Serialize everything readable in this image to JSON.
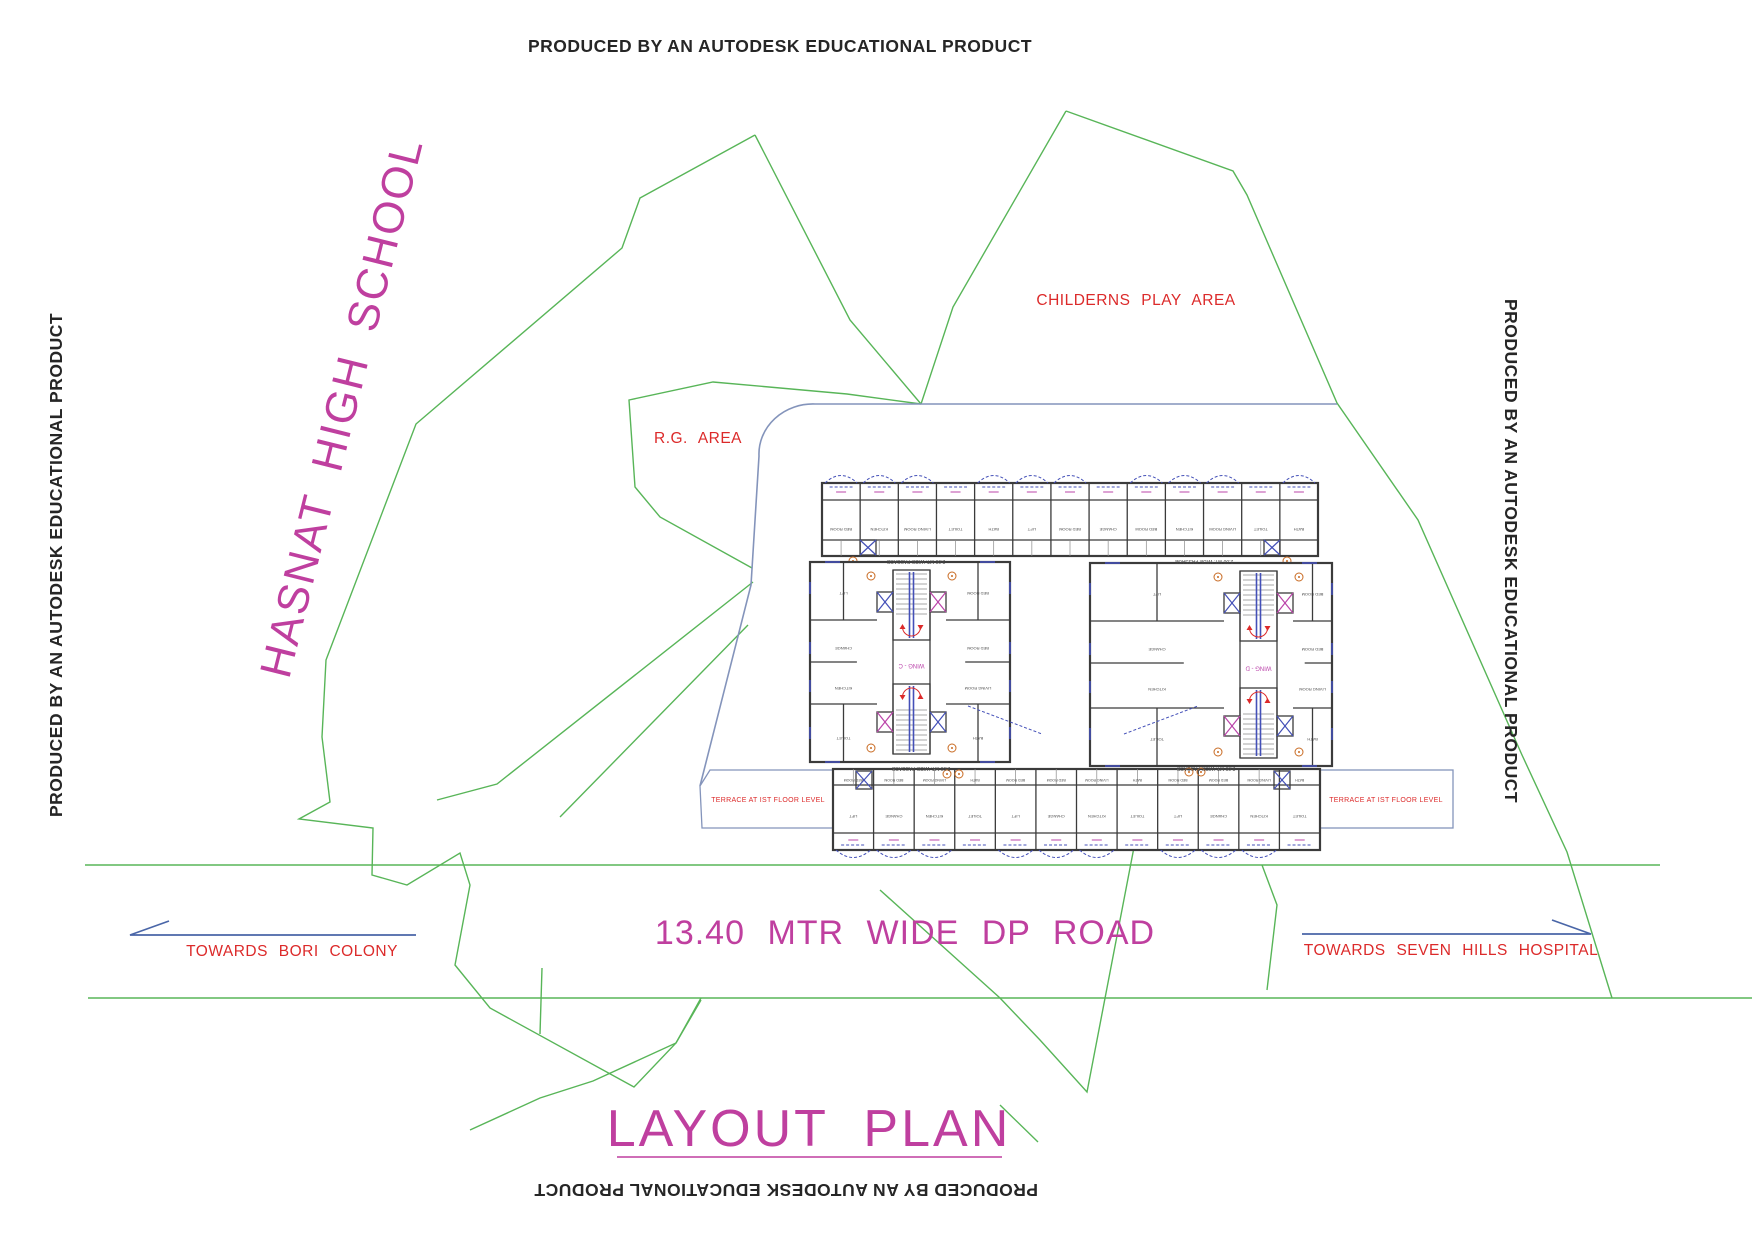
{
  "banners": {
    "produced": "PRODUCED BY AN AUTODESK EDUCATIONAL PRODUCT"
  },
  "site": {
    "school": "HASNAT HIGH SCHOOL",
    "childrens_play_area": "CHILDERNS PLAY AREA",
    "rg_area": "R.G. AREA",
    "road_label": "13.40 MTR WIDE DP ROAD",
    "towards_left": "TOWARDS BORI COLONY",
    "towards_right": "TOWARDS SEVEN HILLS HOSPITAL",
    "plan_title": "LAYOUT PLAN"
  },
  "plan": {
    "terrace_left": "TERRACE AT IST FLOOR LEVEL",
    "terrace_right": "TERRACE AT IST FLOOR LEVEL",
    "passage_label": "2.00 MT. WIDE PASSAGE",
    "wing_left": "WING - C",
    "wing_right": "WING - D",
    "room_labels": [
      "BED ROOM",
      "KITCHEN",
      "LIVING ROOM",
      "TOILET",
      "BATH",
      "LIFT",
      "BED ROOM",
      "CHANGE"
    ]
  },
  "colors": {
    "magenta": "#bf3f9f",
    "magenta_small": "#bb44aa",
    "red": "#dc2a2a",
    "green": "#58b558",
    "wall": "#3b3b3b",
    "plan_blue": "#4450b8",
    "slate_blue": "#8494bb",
    "arrow_blue": "#4a66a8",
    "orange": "#c96b23"
  }
}
